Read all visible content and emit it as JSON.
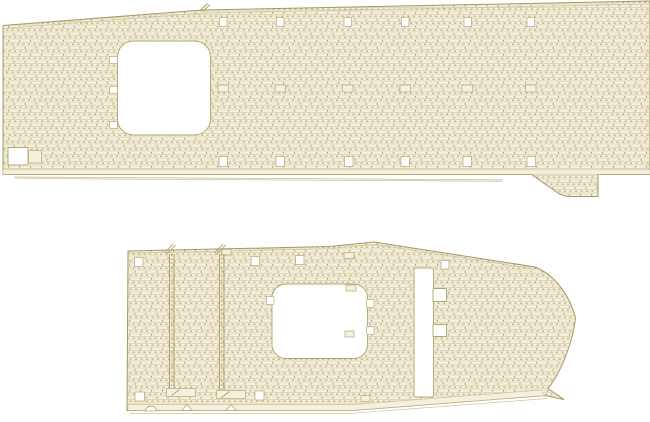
{
  "canvas": {
    "width": 650,
    "height": 422,
    "background": "#ffffff",
    "title": "wooden-deck-planking-sheet-drawing"
  },
  "palette": {
    "plank_bg": "#f2eedb",
    "plank_line": "#dbd2ac",
    "plank_dash": "#a89b66",
    "plank_dot": "#8b7f55",
    "outline": "#a79862",
    "inner_line": "#d0c69e",
    "band_fill": "#f4f0df",
    "hole_fill": "#ffffff",
    "hole_stroke": "#b3a56d",
    "square_stroke": "#bfb183",
    "track": "#ab9b5e",
    "strip_fill": "#f6f2e3",
    "strip_stroke": "#c4b787"
  },
  "parts": [
    {
      "name": "upper-flight-deck",
      "outline": "M3,25.5 L203,10 L650,1 L650,174.5 L598,174.5 L598,196.5 L572,196.5 Q562,196.5 556.5,192 L533,175.5 L532,174.5 L3,174.5 Z",
      "plain_bands": [
        [
          [
            3,
            169.8
          ],
          [
            650,
            169.8
          ],
          [
            650,
            174.2
          ],
          [
            3,
            174.2
          ]
        ]
      ],
      "inner_lines": [
        [
          [
            3,
            28.5
          ],
          [
            203,
            13
          ],
          [
            650,
            4
          ]
        ],
        [
          [
            3,
            169.8
          ],
          [
            650,
            169.8
          ]
        ]
      ],
      "strips": [
        [
          [
            15,
            176.9
          ],
          [
            502,
            179.8
          ],
          [
            502,
            181.3
          ],
          [
            15,
            178.5
          ]
        ]
      ],
      "holes": [
        {
          "name": "elevator-cutout",
          "x": 117.5,
          "y": 41,
          "w": 93,
          "h": 94,
          "r": 16
        },
        {
          "name": "corner-notch",
          "x": 8,
          "y": 147.5,
          "w": 20,
          "h": 17.5,
          "r": 1
        }
      ],
      "hole_tabs": [
        {
          "x": 109.5,
          "y": 56.5,
          "w": 8,
          "h": 7
        },
        {
          "x": 109.5,
          "y": 86.5,
          "w": 8,
          "h": 7
        },
        {
          "x": 109.5,
          "y": 121.5,
          "w": 8,
          "h": 7
        }
      ],
      "white_squares": [
        {
          "x": 219.5,
          "y": 17.5,
          "w": 7.5,
          "h": 9
        },
        {
          "x": 276.5,
          "y": 17.5,
          "w": 7.5,
          "h": 9
        },
        {
          "x": 344,
          "y": 17.5,
          "w": 7.5,
          "h": 9
        },
        {
          "x": 401.5,
          "y": 17.5,
          "w": 7.5,
          "h": 9
        },
        {
          "x": 464,
          "y": 17.5,
          "w": 7.5,
          "h": 9
        },
        {
          "x": 527,
          "y": 17.5,
          "w": 7.5,
          "h": 9
        },
        {
          "x": 219,
          "y": 156.5,
          "w": 8.5,
          "h": 10
        },
        {
          "x": 276,
          "y": 156.5,
          "w": 8.5,
          "h": 10
        },
        {
          "x": 344.5,
          "y": 156.5,
          "w": 8.5,
          "h": 10
        },
        {
          "x": 401,
          "y": 156.5,
          "w": 8.5,
          "h": 10
        },
        {
          "x": 463,
          "y": 156.5,
          "w": 8.5,
          "h": 10
        },
        {
          "x": 527,
          "y": 156.5,
          "w": 8.5,
          "h": 10
        }
      ],
      "outlined_rects": [
        {
          "x": 28.5,
          "y": 150.5,
          "w": 13,
          "h": 12.5
        },
        {
          "x": 218,
          "y": 85,
          "w": 10.5,
          "h": 7
        },
        {
          "x": 275,
          "y": 85,
          "w": 10.5,
          "h": 7
        },
        {
          "x": 342.5,
          "y": 85,
          "w": 10.5,
          "h": 7
        },
        {
          "x": 400,
          "y": 85,
          "w": 10.5,
          "h": 7
        },
        {
          "x": 462,
          "y": 85,
          "w": 10.5,
          "h": 7
        },
        {
          "x": 525.5,
          "y": 85,
          "w": 10.5,
          "h": 7
        }
      ],
      "ticks": [
        "M200,10.5 L207.5,3.5",
        "M202.5,11.5 L210,4.5"
      ]
    },
    {
      "name": "lower-flight-deck",
      "outline": "M128,251 L330,246.5 L374,242 L535,267 C553,274 569,293 575.5,318 C573,341 562,371 548,388.5 L564,399.5 L545,395.5 L352,410.5 L127,410.5 Z",
      "plain_bands": [
        [
          [
            128,
            404.6
          ],
          [
            352,
            404.6
          ],
          [
            541,
            390
          ],
          [
            544.5,
            395.4
          ],
          [
            352,
            410.3
          ],
          [
            128,
            410.3
          ]
        ]
      ],
      "inner_lines": [
        [
          [
            128.5,
            253.2
          ],
          [
            330,
            248.7
          ],
          [
            374,
            244.2
          ],
          [
            534,
            269
          ]
        ],
        [
          [
            128,
            404.6
          ],
          [
            352,
            404.6
          ],
          [
            541,
            390
          ]
        ],
        [
          [
            130,
            413.6
          ],
          [
            349,
            413.6
          ],
          [
            547,
            398.5
          ]
        ]
      ],
      "strips": [],
      "holes": [
        {
          "name": "elevator-cutout",
          "x": 272,
          "y": 284,
          "w": 95.5,
          "h": 74.5,
          "r": 14
        },
        {
          "name": "side-channel",
          "x": 414,
          "y": 268,
          "w": 19.5,
          "h": 129,
          "r": 2
        },
        {
          "name": "channel-notch",
          "x": 433,
          "y": 288.5,
          "w": 13.5,
          "h": 13,
          "r": 1
        },
        {
          "name": "channel-notch",
          "x": 433,
          "y": 324.5,
          "w": 13.5,
          "h": 12,
          "r": 1
        }
      ],
      "hole_tabs": [
        {
          "x": 266.5,
          "y": 296.5,
          "w": 7.5,
          "h": 8
        },
        {
          "x": 366.5,
          "y": 299.5,
          "w": 7.5,
          "h": 8
        },
        {
          "x": 366.5,
          "y": 326.5,
          "w": 7.5,
          "h": 8
        }
      ],
      "white_squares": [
        {
          "x": 134.5,
          "y": 257.5,
          "w": 8.5,
          "h": 9
        },
        {
          "x": 251,
          "y": 256.5,
          "w": 8.5,
          "h": 9
        },
        {
          "x": 295.5,
          "y": 255.5,
          "w": 8.5,
          "h": 9
        },
        {
          "x": 441,
          "y": 260.5,
          "w": 8,
          "h": 8.5
        },
        {
          "x": 135,
          "y": 392,
          "w": 9.5,
          "h": 9
        },
        {
          "x": 255,
          "y": 391,
          "w": 9,
          "h": 9
        }
      ],
      "outlined_rects": [
        {
          "x": 222,
          "y": 249.5,
          "w": 9,
          "h": 5.5
        },
        {
          "x": 344,
          "y": 252.5,
          "w": 10,
          "h": 6
        },
        {
          "x": 346,
          "y": 285,
          "w": 10,
          "h": 6
        },
        {
          "x": 345,
          "y": 331,
          "w": 9,
          "h": 6
        },
        {
          "x": 361,
          "y": 395.5,
          "w": 9,
          "h": 6
        }
      ],
      "tracks": [
        {
          "x": 169.5,
          "y1": 254,
          "y2": 388,
          "hook": {
            "x": 166.5,
            "y": 388.5,
            "w": 29,
            "h": 8
          }
        },
        {
          "x": 219.5,
          "y1": 254,
          "y2": 390,
          "hook": {
            "x": 216.5,
            "y": 390.5,
            "w": 29,
            "h": 8
          }
        }
      ],
      "ticks": [
        "M164.5,253 L173,244",
        "M167,254 L175.5,245",
        "M214.5,253 L223,244",
        "M217,254 L225.5,245"
      ],
      "notches": [
        {
          "type": "arc",
          "cx": 151,
          "cy": 410.5,
          "r": 5.5
        },
        {
          "type": "tri",
          "pts": [
            [
              182,
              410.5
            ],
            [
              187,
              404.5
            ],
            [
              192,
              410.5
            ]
          ]
        },
        {
          "type": "tri",
          "pts": [
            [
              226,
              410.5
            ],
            [
              231,
              404.5
            ],
            [
              236,
              410.5
            ]
          ]
        }
      ]
    }
  ]
}
